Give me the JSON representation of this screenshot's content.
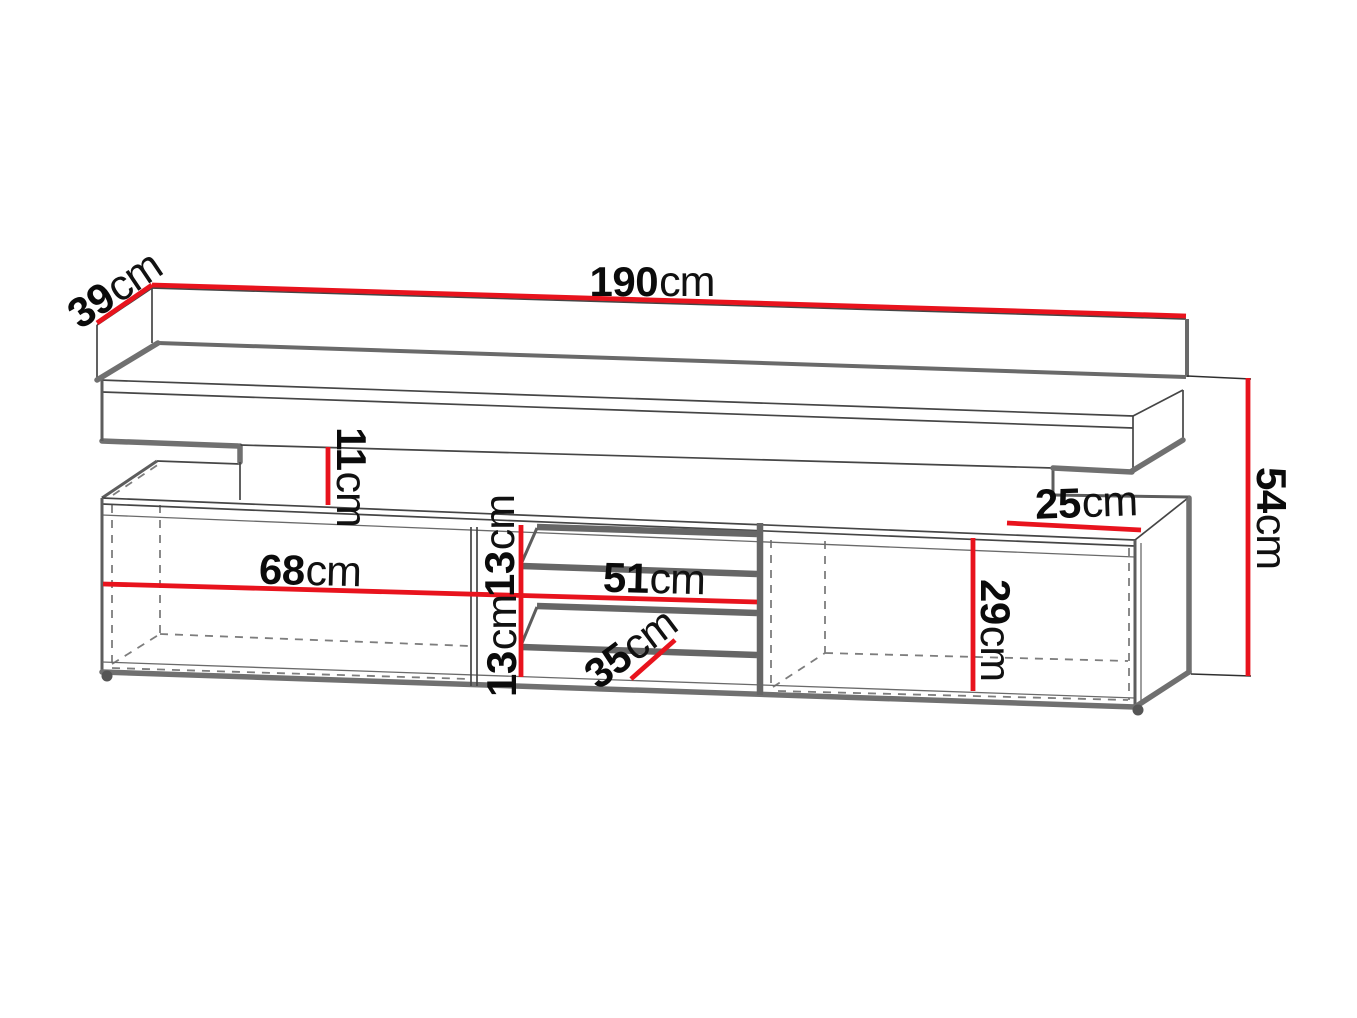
{
  "diagram": {
    "type": "furniture-dimension-drawing",
    "subject": "TV stand / media cabinet technical drawing with dimension lines",
    "unit": "cm",
    "dimensions": {
      "top_width": {
        "value": "190",
        "unit": "cm"
      },
      "top_depth": {
        "value": "39",
        "unit": "cm"
      },
      "recess_height": {
        "value": "11",
        "unit": "cm"
      },
      "upper_slot_height": {
        "value": "13",
        "unit": "cm"
      },
      "lower_slot_height": {
        "value": "13",
        "unit": "cm"
      },
      "left_compartment_width": {
        "value": "68",
        "unit": "cm"
      },
      "center_compartment_width": {
        "value": "51",
        "unit": "cm"
      },
      "slot_depth": {
        "value": "35",
        "unit": "cm"
      },
      "right_top_depth": {
        "value": "25",
        "unit": "cm"
      },
      "right_compartment_height": {
        "value": "29",
        "unit": "cm"
      },
      "lower_unit_height": {
        "value": "54",
        "unit": "cm"
      }
    },
    "colors": {
      "dimension_line": "#e8131d",
      "outline_dark": "#454545",
      "outline_thick": "#707070",
      "label_text": "#0b0b0b",
      "background": "#ffffff"
    }
  }
}
